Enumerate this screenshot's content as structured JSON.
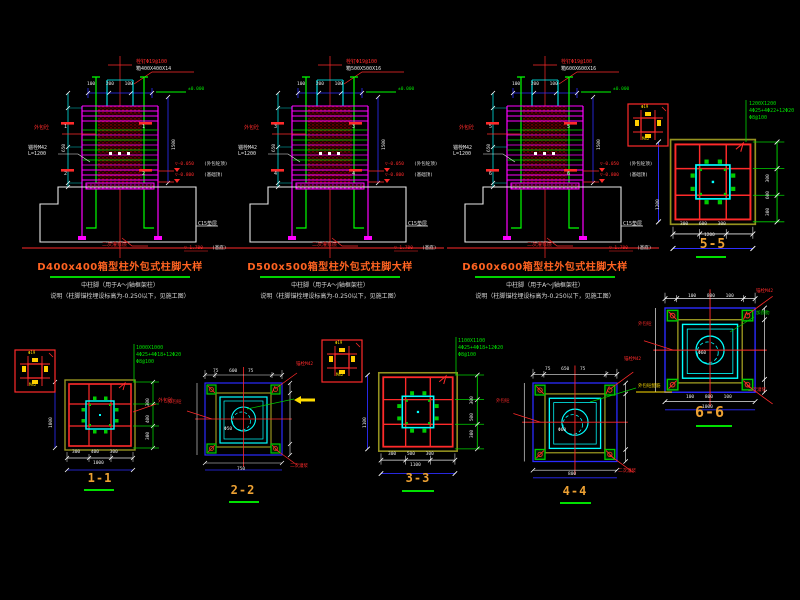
{
  "palette": {
    "background": "#000000",
    "line_red": "#ff2a2a",
    "line_magenta": "#ff00ff",
    "line_green": "#00e000",
    "line_cyan": "#00ffff",
    "line_blue": "#2e2eff",
    "line_olive": "#95921f",
    "title_orange": "#ff6321",
    "label_gold": "#eda133",
    "annotation_yellow": "#ffdd00",
    "text_white": "#e6e6e6"
  },
  "views": [
    {
      "title": "D400x400箱型柱外包式柱脚大样",
      "col": "箱400X400X14",
      "sec_top": "1",
      "sec_bot": "2",
      "note1": "中柱脚（用于A～J轴框架柱）",
      "note2": "说明（柱脚锚栓埋设标高为-0.250以下，见施工图）"
    },
    {
      "title": "D500x500箱型柱外包式柱脚大样",
      "col": "箱500X500X16",
      "sec_top": "3",
      "sec_bot": "4",
      "note1": "中柱脚（用于A～J轴框架柱）",
      "note2": "说明（柱脚锚栓埋设标高为-0.250以下，见施工图）"
    },
    {
      "title": "D600x600箱型柱外包式柱脚大样",
      "col": "箱600X600X16",
      "sec_top": "5",
      "sec_bot": "6",
      "note1": "中柱脚（用于A～J轴框架柱）",
      "note2": "说明（柱脚锚栓埋设标高为-0.250以下，见施工图）"
    }
  ],
  "elev_labels": {
    "stud": "栓钉Φ19@100",
    "ground": "±0.000",
    "encase": "外包砼",
    "anchor1": "锚栓M42",
    "anchor2": "L=1200",
    "lvl_a": "▽-0.050",
    "lvl_a_note": "(外包砼顶)",
    "lvl_b": "▽-0.800",
    "lvl_b_note": "(基础顶)",
    "grout": "二次灌浆层",
    "cushion": "C15垫层",
    "lvl_c": "▽-1.700",
    "lvl_c_note": "(基底)",
    "dim_top": "100 200 100",
    "dim_left": "650",
    "dim_right": "1500"
  },
  "sections": [
    {
      "label": "1-1",
      "spec1": "1000X1000",
      "spec2": "4Φ25+4Φ18+12Φ20",
      "spec3": "Φ8@100",
      "dims": "300 400 300",
      "total": "1000",
      "side": "1000",
      "tag": "外包砼"
    },
    {
      "label": "2-2",
      "dims_top": "75 600 75",
      "dims_bot": "750",
      "hole": "Φ50",
      "t1": "锚栓M42",
      "t2": "二次灌浆",
      "t3": "外包砼"
    },
    {
      "label": "3-3",
      "spec1": "1100X1100",
      "spec2": "4Φ25+4Φ18+12Φ20",
      "spec3": "Φ8@100",
      "dims": "300 500 300",
      "total": "1100",
      "side": "1100"
    },
    {
      "label": "4-4",
      "dims_top": "75 650 75",
      "dims_bot": "800",
      "hole": "Φ60",
      "t1": "锚栓M42",
      "t2": "二次灌浆",
      "t3": "外包砼",
      "t4": "外包砼配筋"
    },
    {
      "label": "5-5",
      "spec1": "1200X1200",
      "spec2": "4Φ25+4Φ22+12Φ20",
      "spec3": "Φ8@100",
      "dims": "300 600 300",
      "total": "1200",
      "side": "1200"
    },
    {
      "label": "6-6",
      "dims_top": "100 800 100",
      "dims_bot": "1000",
      "hole": "Φ60",
      "t1": "锚栓M42",
      "t2": "二次灌浆",
      "t3": "外包砼",
      "t4": "加劲肋"
    }
  ],
  "details": [
    {
      "top": "Φ19",
      "bot": "M42"
    },
    {
      "top": "Φ19",
      "bot": "M42"
    },
    {
      "top": "Φ19",
      "bot": "M42"
    }
  ]
}
